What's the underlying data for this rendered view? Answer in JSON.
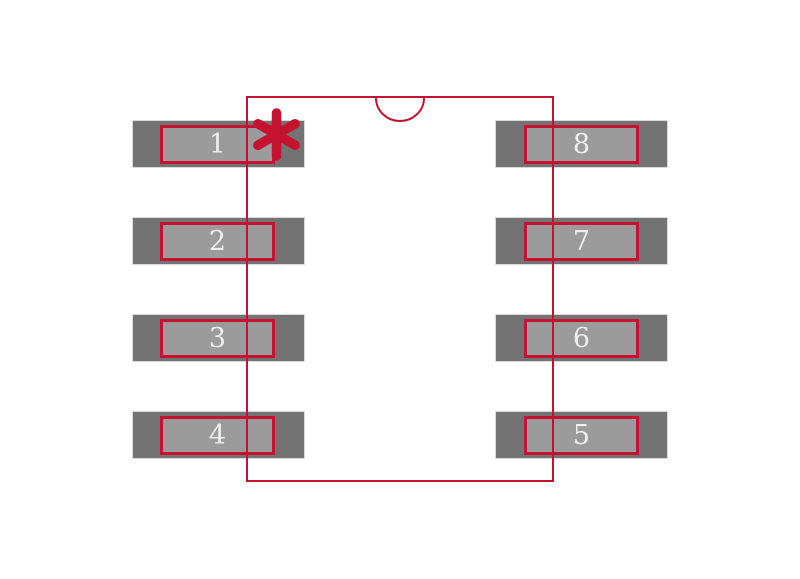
{
  "colors": {
    "background": "#ffffff",
    "outline": "#c51230",
    "pad_outer_gray": "#737373",
    "pad_inner_gray": "#9b9b9b",
    "pad_edge_light": "#d9d9d9",
    "pad_number_text": "#eeeeee"
  },
  "footprint": {
    "pads": [
      {
        "number": "1",
        "side": "left",
        "row": 0
      },
      {
        "number": "2",
        "side": "left",
        "row": 1
      },
      {
        "number": "3",
        "side": "left",
        "row": 2
      },
      {
        "number": "4",
        "side": "left",
        "row": 3
      },
      {
        "number": "8",
        "side": "right",
        "row": 0
      },
      {
        "number": "7",
        "side": "right",
        "row": 1
      },
      {
        "number": "6",
        "side": "right",
        "row": 2
      },
      {
        "number": "5",
        "side": "right",
        "row": 3
      }
    ],
    "markers": {
      "pin1_marker": "asterisk-icon",
      "orientation_marker": "semicircle-notch-icon"
    }
  }
}
